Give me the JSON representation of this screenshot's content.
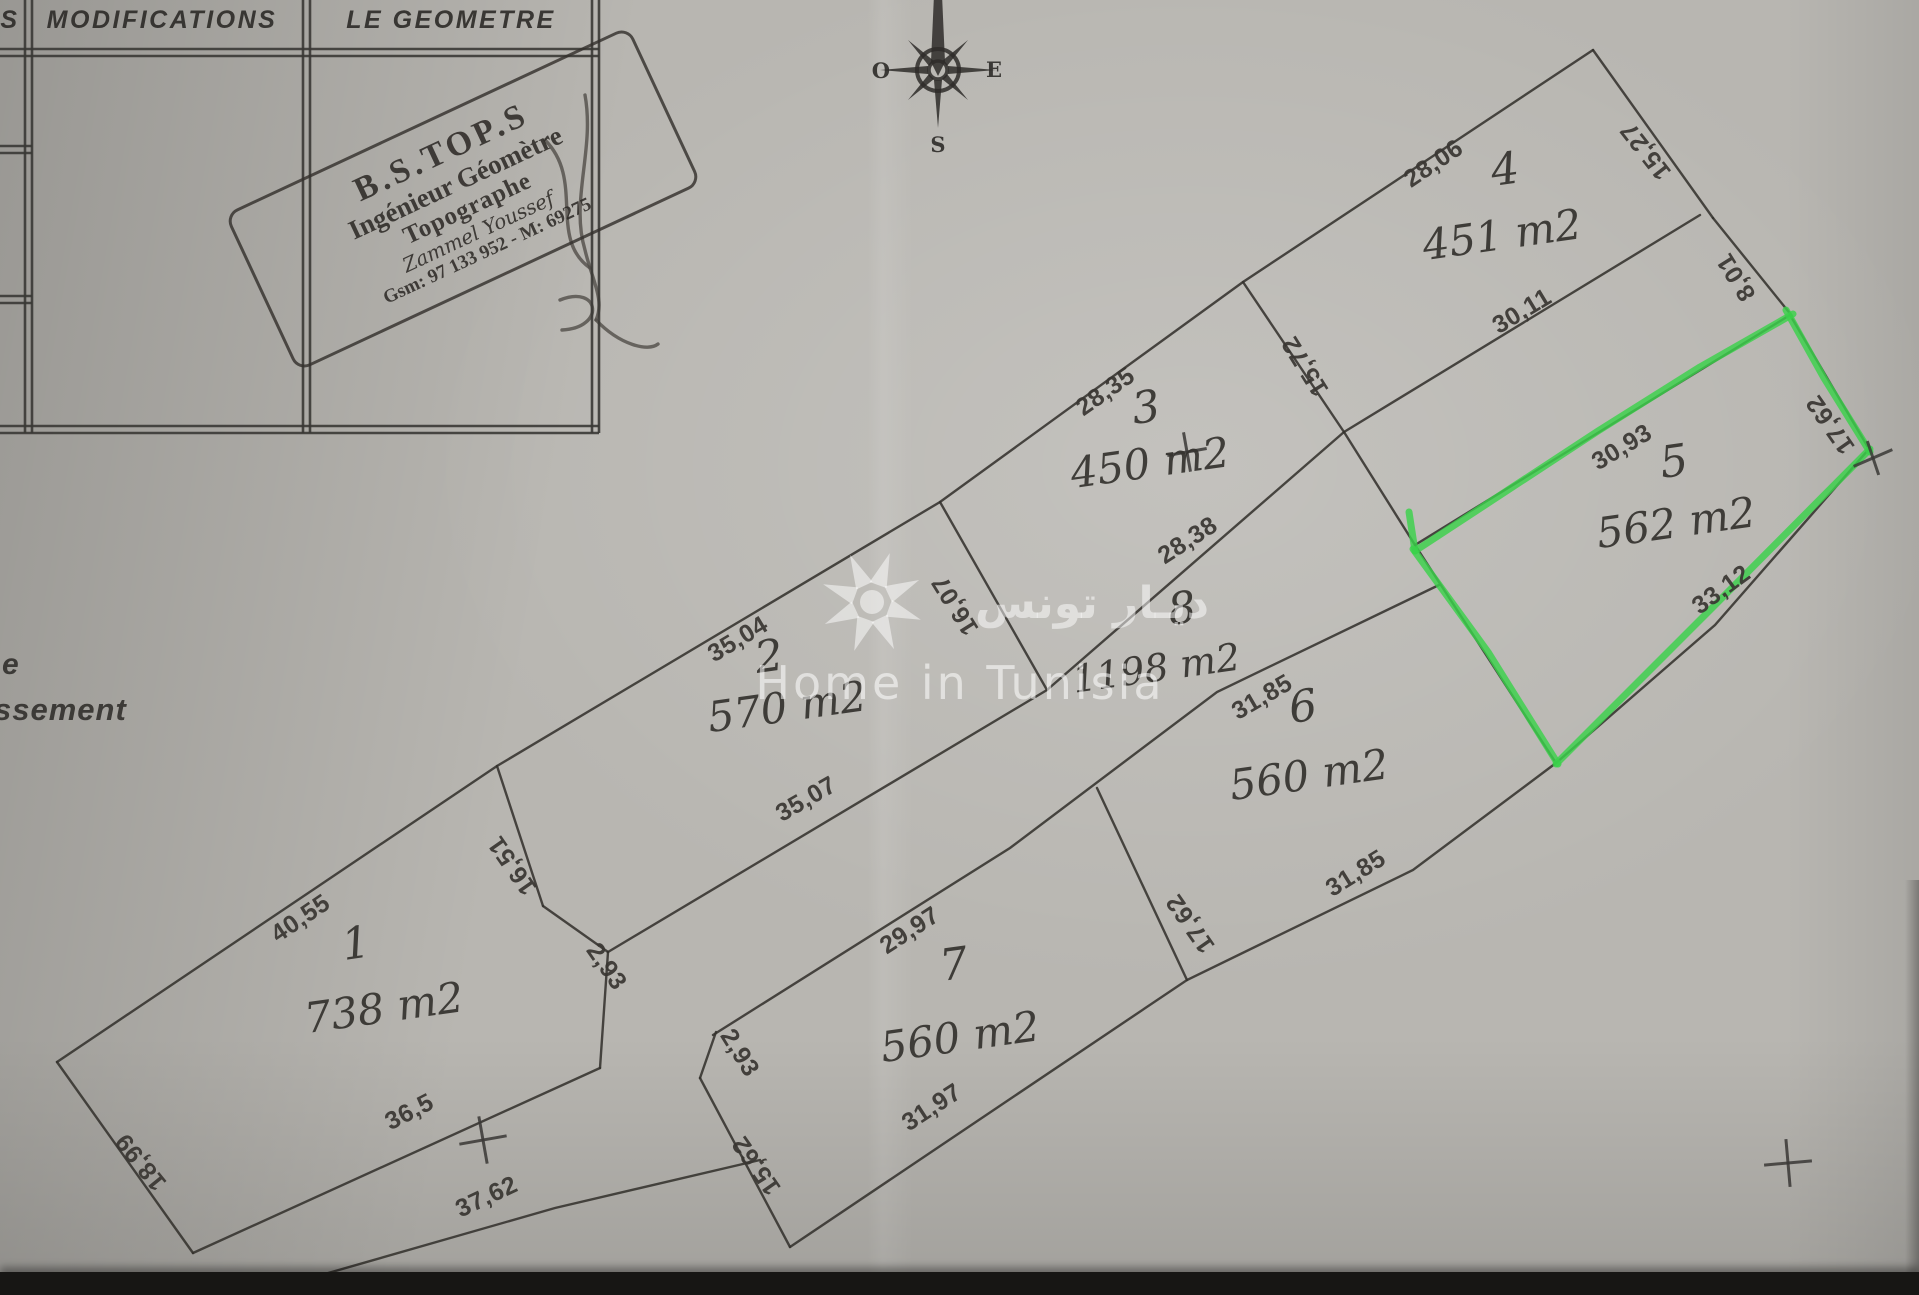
{
  "paper_color": "#b8b6b1",
  "ink_color": "#34322e",
  "highlight_color": "#3ad24b",
  "table": {
    "col_left_fragment": "S",
    "col_modifications": "MODIFICATIONS",
    "col_geometre": "LE GEOMETRE"
  },
  "stamp": {
    "company": "B.S.TOP.S",
    "title1": "Ingénieur Géomètre",
    "title2": "Topographe",
    "name": "Zammel Youssef",
    "phone": "Gsm: 97 133 952 - M: 69275"
  },
  "compass": {
    "west": "O",
    "east": "E",
    "south": "S"
  },
  "watermark": {
    "arabic_text": "ديـار تونس",
    "latin_text": "Home in Tunisia"
  },
  "margin_text_fragments": {
    "line1": "e",
    "line2": "ssement"
  },
  "parcels": [
    {
      "id": "p1",
      "number": "1",
      "area": "738 m2",
      "highlighted": false
    },
    {
      "id": "p2",
      "number": "2",
      "area": "570 m2",
      "highlighted": false
    },
    {
      "id": "p3",
      "number": "3",
      "area": "450 m2",
      "highlighted": false
    },
    {
      "id": "p4",
      "number": "4",
      "area": "451 m2",
      "highlighted": false
    },
    {
      "id": "p5",
      "number": "5",
      "area": "562 m2",
      "highlighted": true
    },
    {
      "id": "p6",
      "number": "6",
      "area": "560 m2",
      "highlighted": false
    },
    {
      "id": "p7",
      "number": "7",
      "area": "560 m2",
      "highlighted": false
    },
    {
      "id": "p8",
      "number": "8",
      "area": "1198 m2",
      "highlighted": false
    }
  ],
  "dimension_labels": [
    {
      "id": "d40_55",
      "text": "40,55"
    },
    {
      "id": "d35_04",
      "text": "35,04"
    },
    {
      "id": "d28_35",
      "text": "28,35"
    },
    {
      "id": "d28_06",
      "text": "28,06"
    },
    {
      "id": "d15_27",
      "text": "15,27"
    },
    {
      "id": "d8_01",
      "text": "8,01"
    },
    {
      "id": "d30_11",
      "text": "30,11"
    },
    {
      "id": "d15_72",
      "text": "15,72"
    },
    {
      "id": "d16_07",
      "text": "16,07"
    },
    {
      "id": "d28_38",
      "text": "28,38"
    },
    {
      "id": "d35_07",
      "text": "35,07"
    },
    {
      "id": "d16_51",
      "text": "16,51"
    },
    {
      "id": "d2_93a",
      "text": "2,93"
    },
    {
      "id": "d2_93b",
      "text": "2,93"
    },
    {
      "id": "d29_97",
      "text": "29,97"
    },
    {
      "id": "d30_93",
      "text": "30,93"
    },
    {
      "id": "d17_62a",
      "text": "17,62"
    },
    {
      "id": "d33_12",
      "text": "33,12"
    },
    {
      "id": "d31_85a",
      "text": "31,85"
    },
    {
      "id": "d17_62b",
      "text": "17,62"
    },
    {
      "id": "d31_85b",
      "text": "31,85"
    },
    {
      "id": "d15_62",
      "text": "15,62"
    },
    {
      "id": "d18_99",
      "text": "18,99"
    },
    {
      "id": "d36_5",
      "text": "36,5"
    },
    {
      "id": "d37_62",
      "text": "37,62"
    },
    {
      "id": "d31_97",
      "text": "31,97"
    }
  ]
}
